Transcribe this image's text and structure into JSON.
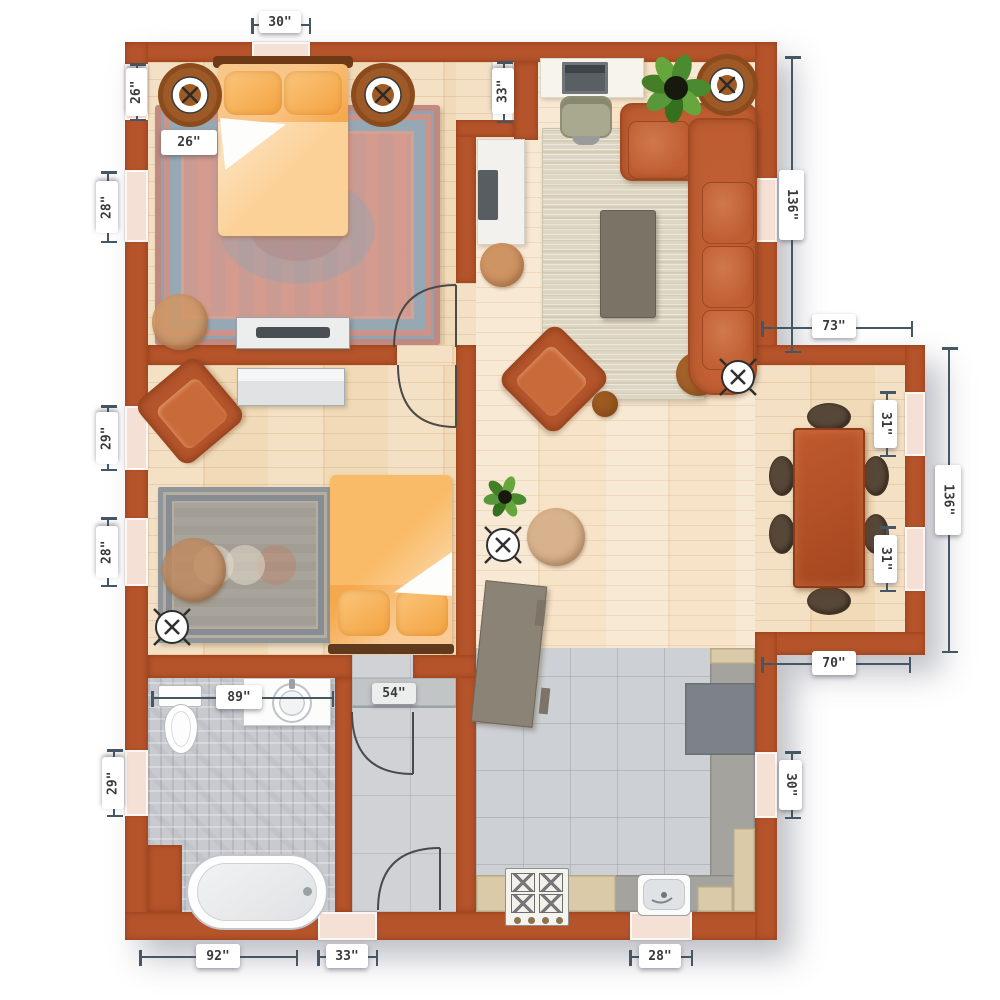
{
  "plan": {
    "type": "apartment-floor-plan",
    "rooms": [
      "bedroom-1",
      "bedroom-2",
      "living-room",
      "dining-area",
      "kitchen",
      "bathroom",
      "closet",
      "hallway"
    ],
    "colors": {
      "wall": "#b5532a",
      "wood_floor": "#f1dab7",
      "living_floor": "#f6e3c8",
      "kitchen_tile": "#cdd0d4",
      "bathroom_tile": "#c8cacf",
      "closet_floor": "#d0d2d6",
      "window": "#f4e0d5",
      "sofa": "#b9582f",
      "bed": "#f7ad52",
      "dining_table": "#b4512a",
      "rug_bedroom1": "#d39a8d",
      "rug_bedroom2": "#a8a49b",
      "rug_living": "#ddd6c3",
      "counter": "#a5a39e",
      "counter_tan": "#dacaa8",
      "dimension_line": "#455664"
    },
    "labels": {
      "top_window_30": "30\"",
      "left_window_26": "26\"",
      "bed_width_26": "26\"",
      "left_window_28a": "28\"",
      "left_window_29a": "29\"",
      "left_window_28b": "28\"",
      "left_window_29b": "29\"",
      "entry_opening_33": "33\"",
      "living_wall_136": "136\"",
      "dining_top_73": "73\"",
      "dining_window_31a": "31\"",
      "dining_window_31b": "31\"",
      "dining_wall_136": "136\"",
      "dining_bottom_70": "70\"",
      "kitchen_window_30": "30\"",
      "bathroom_width_89": "89\"",
      "closet_width_54": "54\"",
      "bottom_bathroom_92": "92\"",
      "bottom_door_33": "33\"",
      "bottom_window_28": "28\""
    }
  }
}
